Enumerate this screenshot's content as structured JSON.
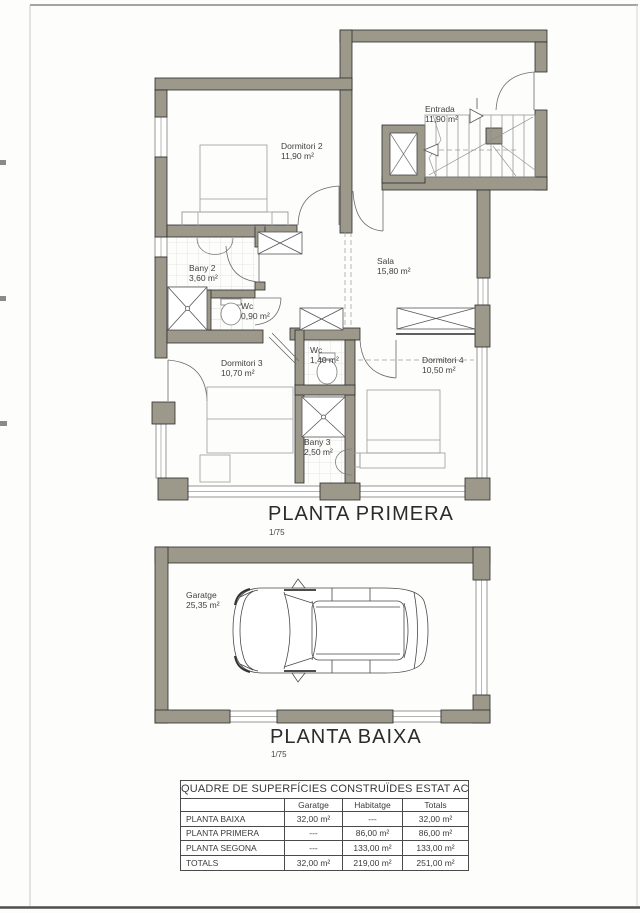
{
  "plans": [
    {
      "name": "PLANTA PRIMERA",
      "scale": "1/75",
      "rooms": [
        {
          "label": "Dormitori 2",
          "area": "11,90 m²"
        },
        {
          "label": "Entrada",
          "area": "11,90 m²"
        },
        {
          "label": "Sala",
          "area": "15,80 m²"
        },
        {
          "label": "Bany 2",
          "area": "3,60 m²"
        },
        {
          "label": "Wc",
          "area": "0,90 m²"
        },
        {
          "label": "Dormitori 3",
          "area": "10,70 m²"
        },
        {
          "label": "Wc",
          "area": "1,40 m²"
        },
        {
          "label": "Dormitori 4",
          "area": "10,50 m²"
        },
        {
          "label": "Bany 3",
          "area": "2,50 m²"
        }
      ]
    },
    {
      "name": "PLANTA BAIXA",
      "scale": "1/75",
      "rooms": [
        {
          "label": "Garatge",
          "area": "25,35 m²"
        }
      ]
    }
  ],
  "table": {
    "title": "QUADRE DE SUPERFÍCIES CONSTRUÏDES ESTAT ACTUAL",
    "columns": [
      "",
      "Garatge",
      "Habitatge",
      "Totals"
    ],
    "rows": [
      [
        "PLANTA BAIXA",
        "32,00 m²",
        "---",
        "32,00 m²"
      ],
      [
        "PLANTA PRIMERA",
        "---",
        "86,00 m²",
        "86,00 m²"
      ],
      [
        "PLANTA SEGONA",
        "---",
        "133,00 m²",
        "133,00 m²"
      ],
      [
        "TOTALS",
        "32,00 m²",
        "219,00 m²",
        "251,00 m²"
      ]
    ]
  },
  "colors": {
    "wall": "#9c988a",
    "line": "#2b2b2b"
  }
}
